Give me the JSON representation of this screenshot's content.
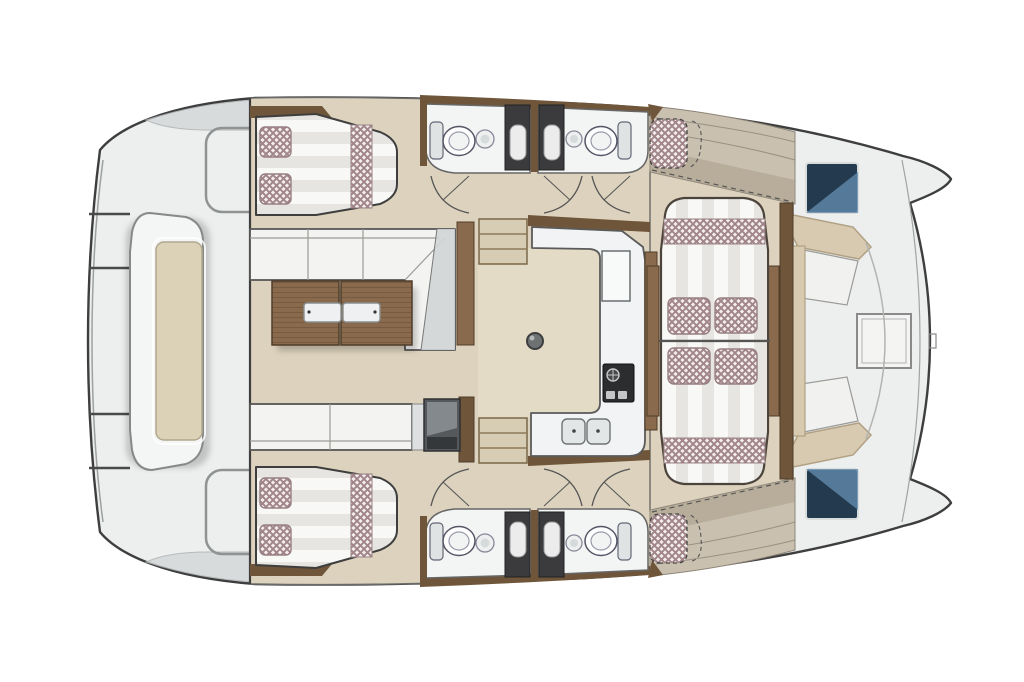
{
  "document": {
    "kind": "boat-floor-plan",
    "description": "Catamaran interior layout, top-down plan view, no visible text labels",
    "orientation": {
      "bow": "right",
      "stern": "left",
      "symmetry": "mirrored about horizontal centerline"
    }
  },
  "palette": {
    "background": "#ffffff",
    "deck": "#edeeee",
    "outline": "#3e3e3e",
    "floor": "#dcd2bd",
    "floor_light": "#e4dbc7",
    "wood": "#8a6a4c",
    "wood_dark": "#6f5539",
    "wood_edge": "#4f3d2a",
    "cushion": "#f3f3f1",
    "cushion_shade": "#d2d5d6",
    "check_base": "#f3eded",
    "check_line": "#a18589",
    "stripe_a": "#f8f8f6",
    "stripe_b": "#e6e5e1",
    "charcoal": "#3b3b3e",
    "hatch_dark": "#243a4e",
    "hatch_light": "#628bad",
    "beige_bench": "#d8cab0",
    "beige_bench_edge": "#b1a184",
    "counter": "#f2f3f4",
    "tan_deck": "#c9c0af",
    "tan_deck_dark": "#a59a86"
  },
  "areas": [
    {
      "id": "aft-deck",
      "name": "aft deck platform with console table and transom steps"
    },
    {
      "id": "cabin-port",
      "name": "port double berth cabin with pillows and runner"
    },
    {
      "id": "cabin-starboard",
      "name": "starboard double berth cabin with pillows and runner"
    },
    {
      "id": "salon",
      "name": "salon with L-sofa, chaise corner, bench sofa, twin wood coffee tables"
    },
    {
      "id": "bathrooms-port",
      "name": "two port bathrooms with toilet, sink, shower column"
    },
    {
      "id": "bathrooms-starboard",
      "name": "two starboard bathrooms with toilet, sink, shower column"
    },
    {
      "id": "galley",
      "name": "U-shaped galley with fridge, stove, double sink"
    },
    {
      "id": "dinette",
      "name": "facing-bench dinette with checkered cushions and side tables"
    },
    {
      "id": "forward-cockpit",
      "name": "forward cockpit corner benches with square table"
    },
    {
      "id": "foredeck",
      "name": "foredeck with two glass hatches, sunpads and twin bows"
    }
  ],
  "element_counts": {
    "berths": 2,
    "toilets": 4,
    "bath_sinks": 4,
    "showers": 4,
    "deck_hatches": 2,
    "sunpads": 2,
    "stairs": 2,
    "door_swings": 6,
    "coffee_tables": 2,
    "dinette_pillows": 4
  }
}
